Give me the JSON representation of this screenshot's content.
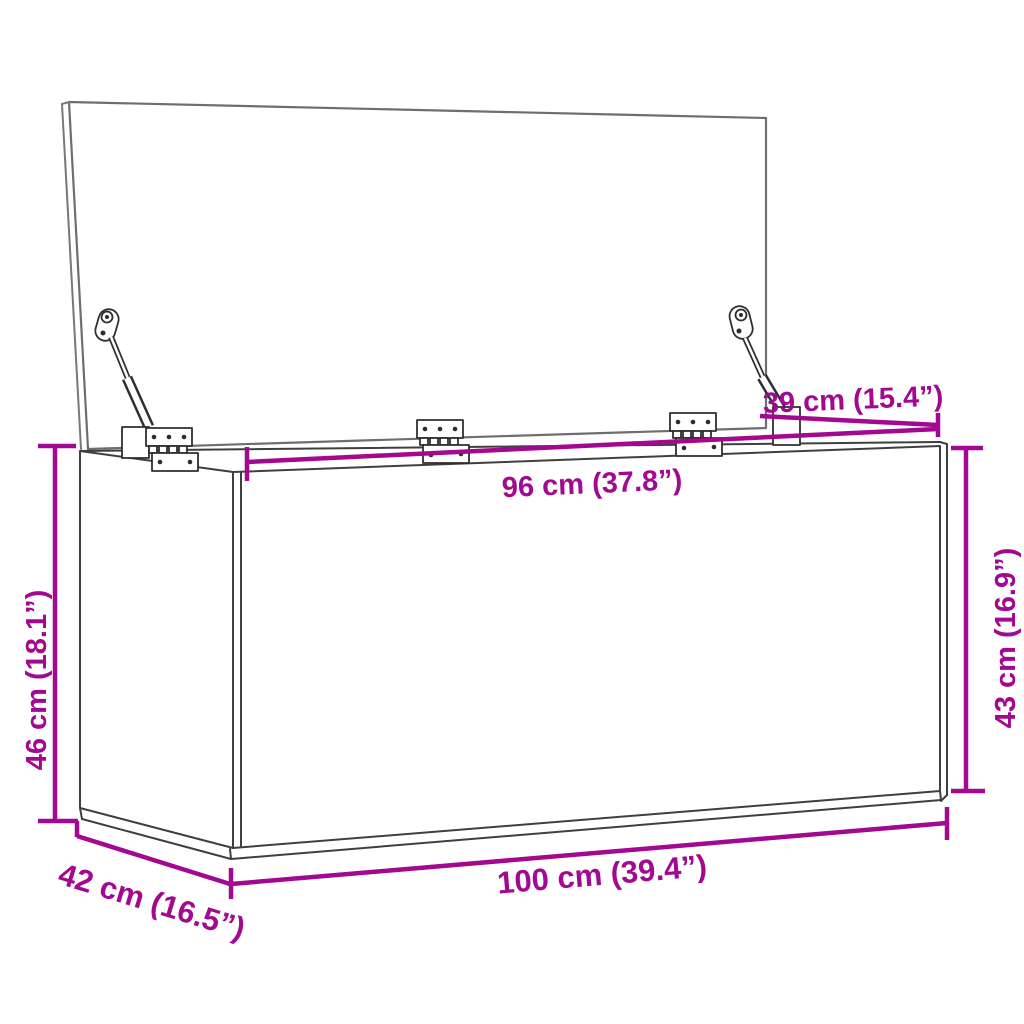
{
  "diagram": {
    "title": "Storage box dimension diagram",
    "product": "Storage chest with open lid, two lid stays and three hinges",
    "view": "three-quarter front perspective line drawing",
    "background_color": "#ffffff",
    "outline_color": "#3f3f3f",
    "accent_color": "#a20890",
    "dimensions": {
      "lid_depth": {
        "value_cm": 39,
        "value_in": 15.4,
        "label": "39 cm (15.4”)"
      },
      "inner_width": {
        "value_cm": 96,
        "value_in": 37.8,
        "label": "96 cm (37.8”)"
      },
      "height_right": {
        "value_cm": 43,
        "value_in": 16.9,
        "label": "43 cm (16.9”)"
      },
      "height_left": {
        "value_cm": 46,
        "value_in": 18.1,
        "label": "46 cm (18.1”)"
      },
      "depth": {
        "value_cm": 42,
        "value_in": 16.5,
        "label": "42 cm (16.5”)"
      },
      "width": {
        "value_cm": 100,
        "value_in": 39.4,
        "label": "100 cm (39.4”)"
      }
    }
  }
}
